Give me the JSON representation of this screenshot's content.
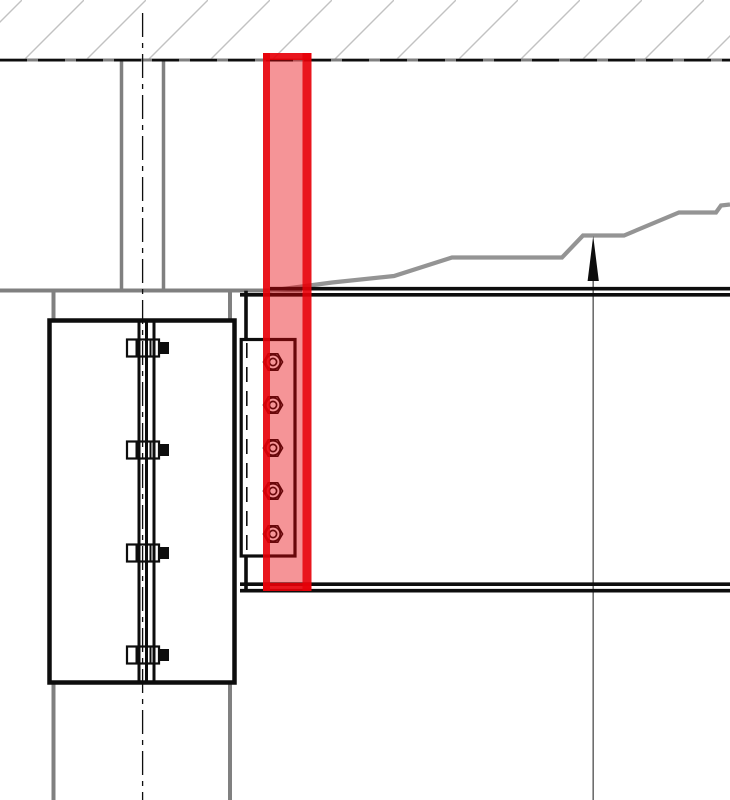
{
  "drawing": {
    "kind": "steel-connection-detail",
    "description_present_text": ""
  },
  "colors": {
    "background": "#ffffff",
    "black": "#0d0d0d",
    "gray": "#808080",
    "hatch": "#c2c2c2",
    "profile": "#949494",
    "leader": "#6e6e6e",
    "highlight": "#e60008",
    "plate_fill": "#ffffff"
  },
  "highlight": {
    "fill_opacity": 0.42,
    "edge_opacity": 0.85
  },
  "profile_line": {
    "points": "268,291 332,282.5 394,276 452,257.5 562,257.5 583,235.5 624,235.5 679,212.5 716,212.5 721,205.5 730,204.5"
  },
  "end_plate_bolts": {
    "count": 5,
    "cy": [
      362,
      405,
      448,
      491,
      534
    ]
  },
  "splice_bolts": {
    "count": 4,
    "cy": [
      348,
      450,
      553,
      655
    ]
  }
}
